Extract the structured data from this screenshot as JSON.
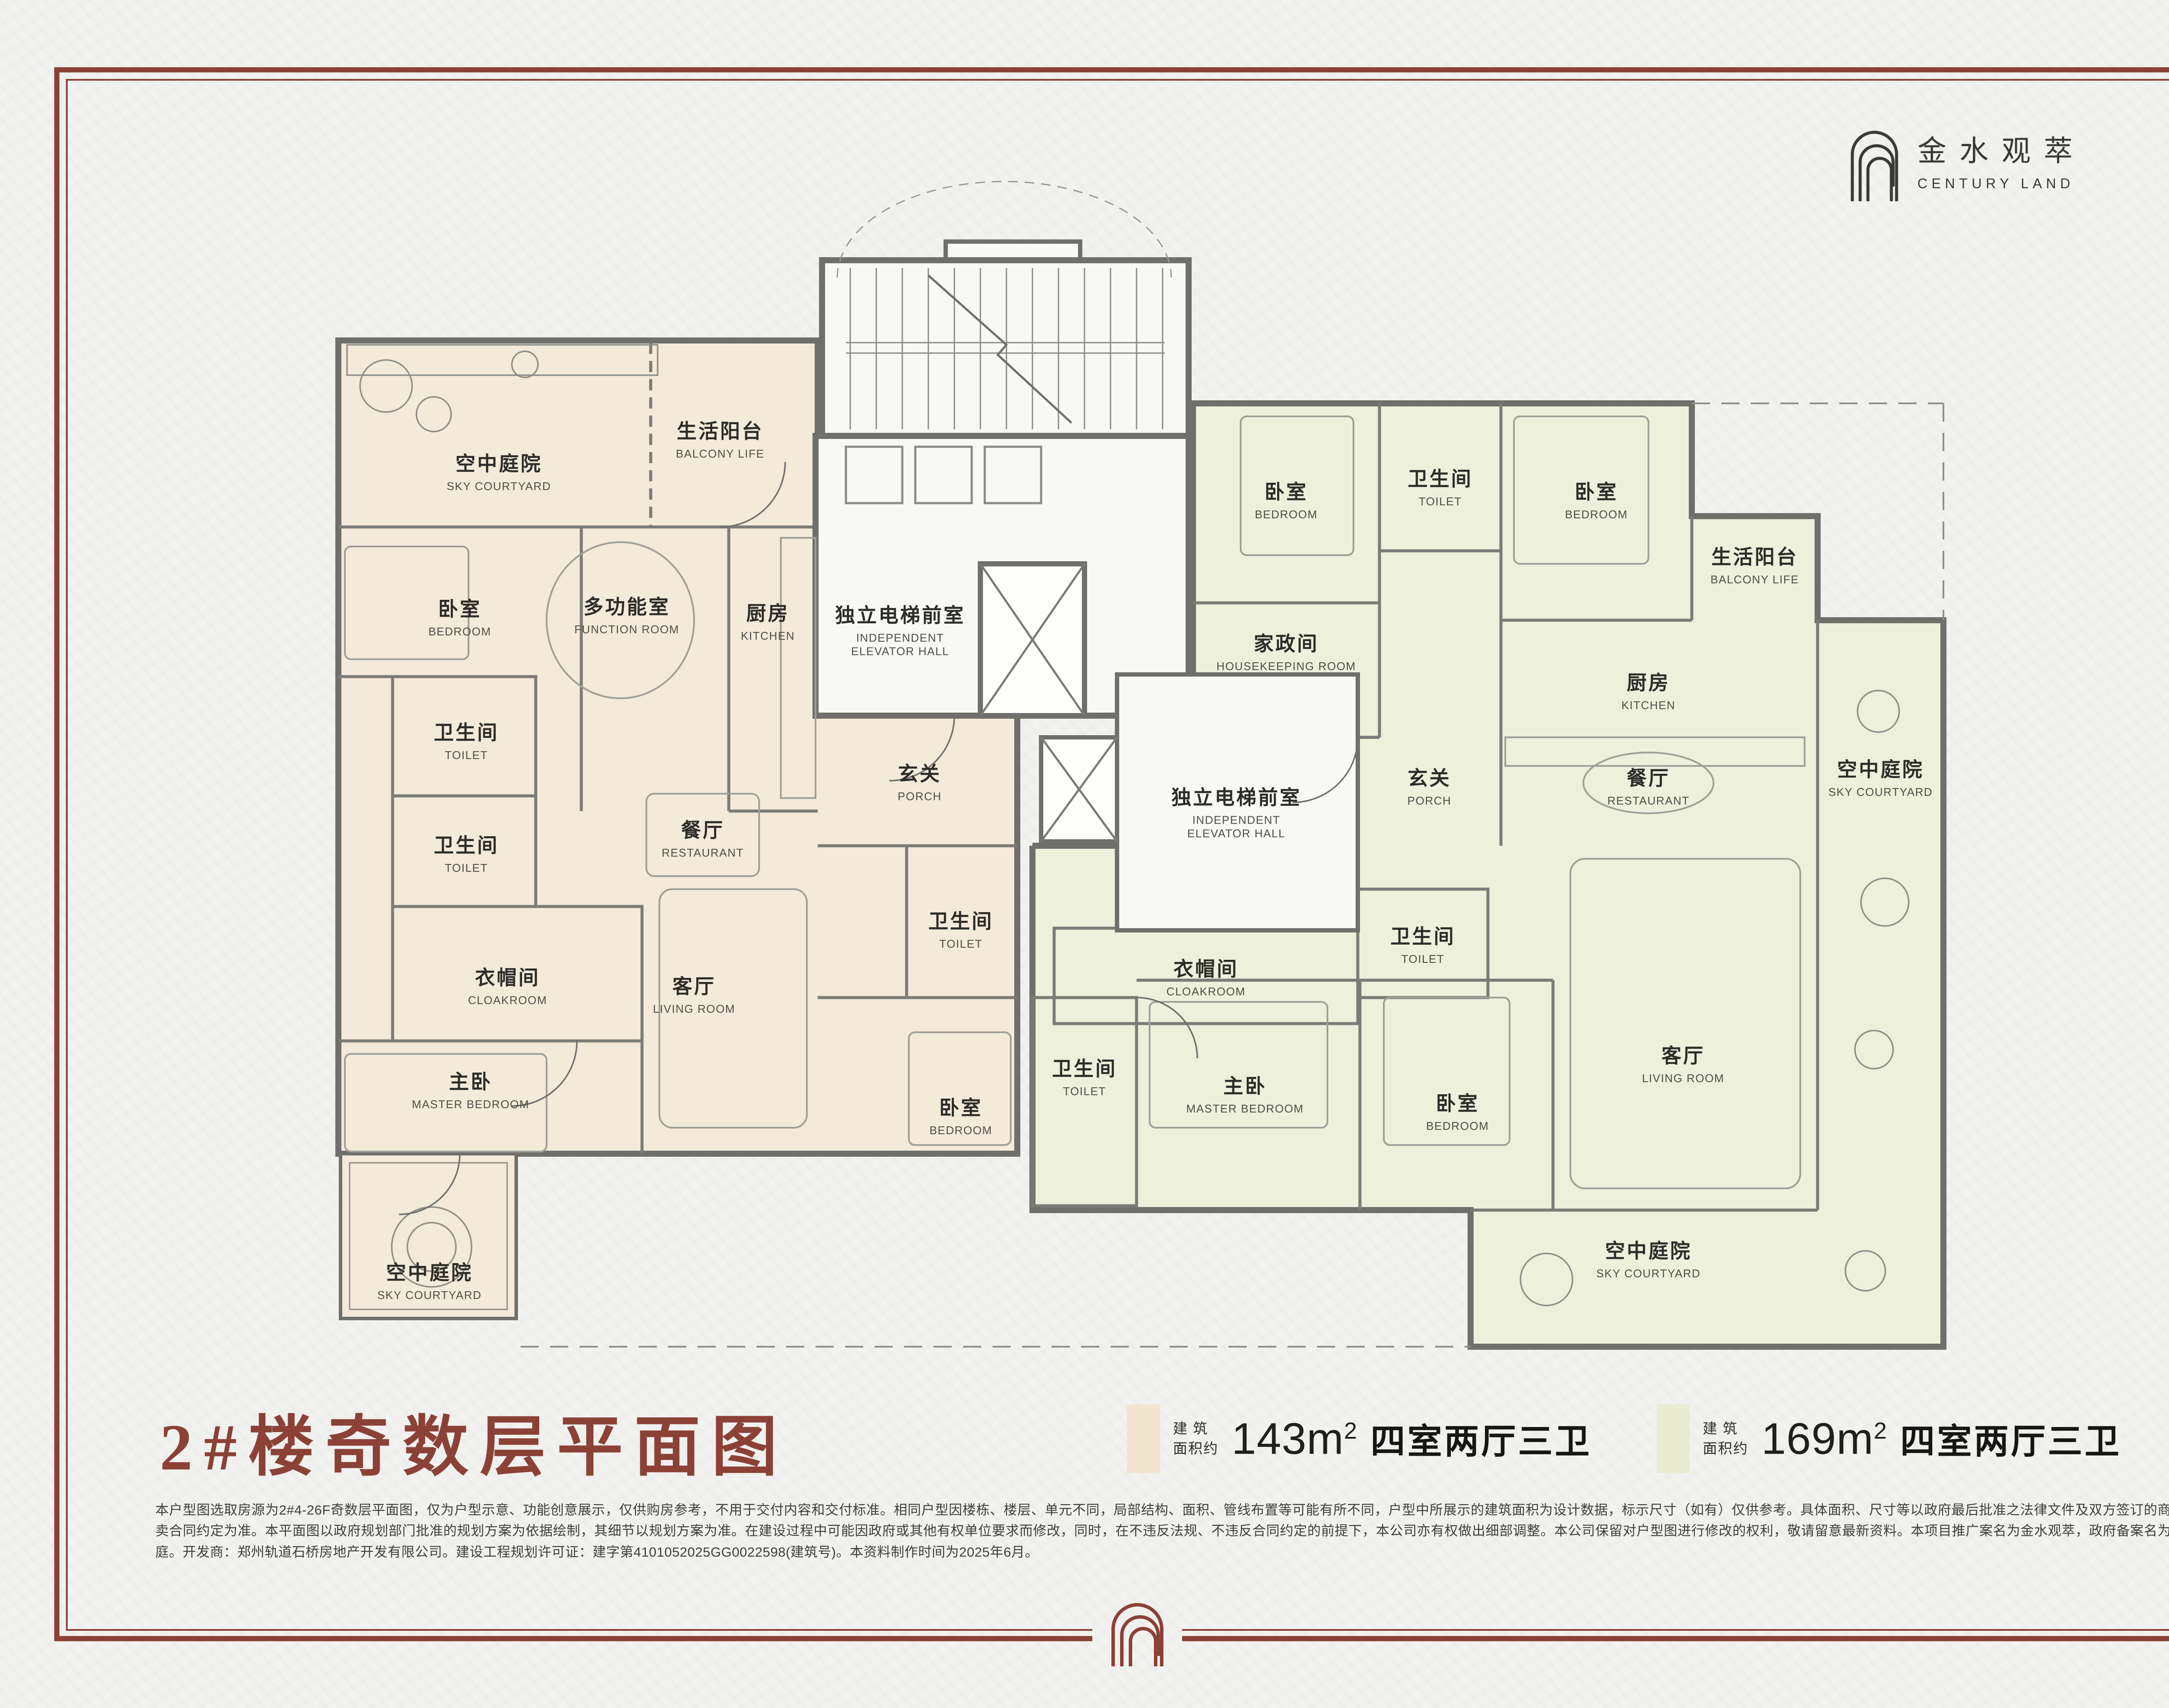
{
  "brand": {
    "name_cn": "金水观萃",
    "name_en": "CENTURY LAND"
  },
  "page": {
    "title": "2#楼奇数层平面图"
  },
  "legend": {
    "items": [
      {
        "swatch_color": "#f2e5cf",
        "prefix": "建 筑\n面积约",
        "area_value": "143m",
        "area_sup": "2",
        "layout_label": "四室两厅三卫"
      },
      {
        "swatch_color": "#e9ecd0",
        "prefix": "建 筑\n面积约",
        "area_value": "169m",
        "area_sup": "2",
        "layout_label": "四室两厅三卫"
      }
    ]
  },
  "colors": {
    "accent": "#8c4136",
    "unit143_fill": "#f4ead9",
    "unit169_fill": "#edf0db",
    "wall": "#6f6f6c"
  },
  "disclaimer": "本户型图选取房源为2#4-26F奇数层平面图，仅为户型示意、功能创意展示，仅供购房参考，不用于交付内容和交付标准。相同户型因楼栋、楼层、单元不同，局部结构、面积、管线布置等可能有所不同，户型中所展示的建筑面积为设计数据，标示尺寸（如有）仅供参考。具体面积、尺寸等以政府最后批准之法律文件及双方签订的商品房买卖合同约定为准。本平面图以政府规划部门批准的规划方案为依据绘制，其细节以规划方案为准。在建设过程中可能因政府或其他有权单位要求而修改，同时，在不违反法规、不违反合同约定的前提下，本公司亦有权做出细部调整。本公司保留对户型图进行修改的权利，敬请留意最新资料。本项目推广案名为金水观萃，政府备案名为观越华庭。开发商：郑州轨道石桥房地产开发有限公司。建设工程规划许可证：建字第4101052025GG0022598(建筑号)。本资料制作时间为2025年6月。",
  "rooms": {
    "u143": {
      "sky_courtyard_top": {
        "cn": "空中庭院",
        "en": "SKY COURTYARD"
      },
      "balcony_life": {
        "cn": "生活阳台",
        "en": "BALCONY LIFE"
      },
      "bedroom_a": {
        "cn": "卧室",
        "en": "BEDROOM"
      },
      "function_room": {
        "cn": "多功能室",
        "en": "FUNCTION ROOM"
      },
      "kitchen": {
        "cn": "厨房",
        "en": "KITCHEN"
      },
      "elevator_hall": {
        "cn": "独立电梯前室",
        "en": "INDEPENDENT ELEVATOR HALL"
      },
      "toilet_a": {
        "cn": "卫生间",
        "en": "TOILET"
      },
      "toilet_b": {
        "cn": "卫生间",
        "en": "TOILET"
      },
      "restaurant": {
        "cn": "餐厅",
        "en": "RESTAURANT"
      },
      "porch": {
        "cn": "玄关",
        "en": "PORCH"
      },
      "cloakroom": {
        "cn": "衣帽间",
        "en": "CLOAKROOM"
      },
      "living_room": {
        "cn": "客厅",
        "en": "LIVING ROOM"
      },
      "master_bedroom": {
        "cn": "主卧",
        "en": "MASTER BEDROOM"
      },
      "toilet_c": {
        "cn": "卫生间",
        "en": "TOILET"
      },
      "bedroom_b": {
        "cn": "卧室",
        "en": "BEDROOM"
      },
      "sky_courtyard_bottom": {
        "cn": "空中庭院",
        "en": "SKY COURTYARD"
      }
    },
    "u169": {
      "bedroom_a": {
        "cn": "卧室",
        "en": "BEDROOM"
      },
      "toilet_a": {
        "cn": "卫生间",
        "en": "TOILET"
      },
      "bedroom_b": {
        "cn": "卧室",
        "en": "BEDROOM"
      },
      "housekeeping": {
        "cn": "家政间",
        "en": "HOUSEKEEPING ROOM"
      },
      "balcony_life": {
        "cn": "生活阳台",
        "en": "BALCONY LIFE"
      },
      "kitchen": {
        "cn": "厨房",
        "en": "KITCHEN"
      },
      "elevator_hall": {
        "cn": "独立电梯前室",
        "en": "INDEPENDENT ELEVATOR HALL"
      },
      "porch": {
        "cn": "玄关",
        "en": "PORCH"
      },
      "restaurant": {
        "cn": "餐厅",
        "en": "RESTAURANT"
      },
      "cloakroom": {
        "cn": "衣帽间",
        "en": "CLOAKROOM"
      },
      "toilet_b": {
        "cn": "卫生间",
        "en": "TOILET"
      },
      "toilet_c": {
        "cn": "卫生间",
        "en": "TOILET"
      },
      "master_bedroom": {
        "cn": "主卧",
        "en": "MASTER BEDROOM"
      },
      "bedroom_c": {
        "cn": "卧室",
        "en": "BEDROOM"
      },
      "living_room": {
        "cn": "客厅",
        "en": "LIVING ROOM"
      },
      "sky_courtyard_right": {
        "cn": "空中庭院",
        "en": "SKY COURTYARD"
      },
      "sky_courtyard_bottom": {
        "cn": "空中庭院",
        "en": "SKY COURTYARD"
      }
    }
  }
}
